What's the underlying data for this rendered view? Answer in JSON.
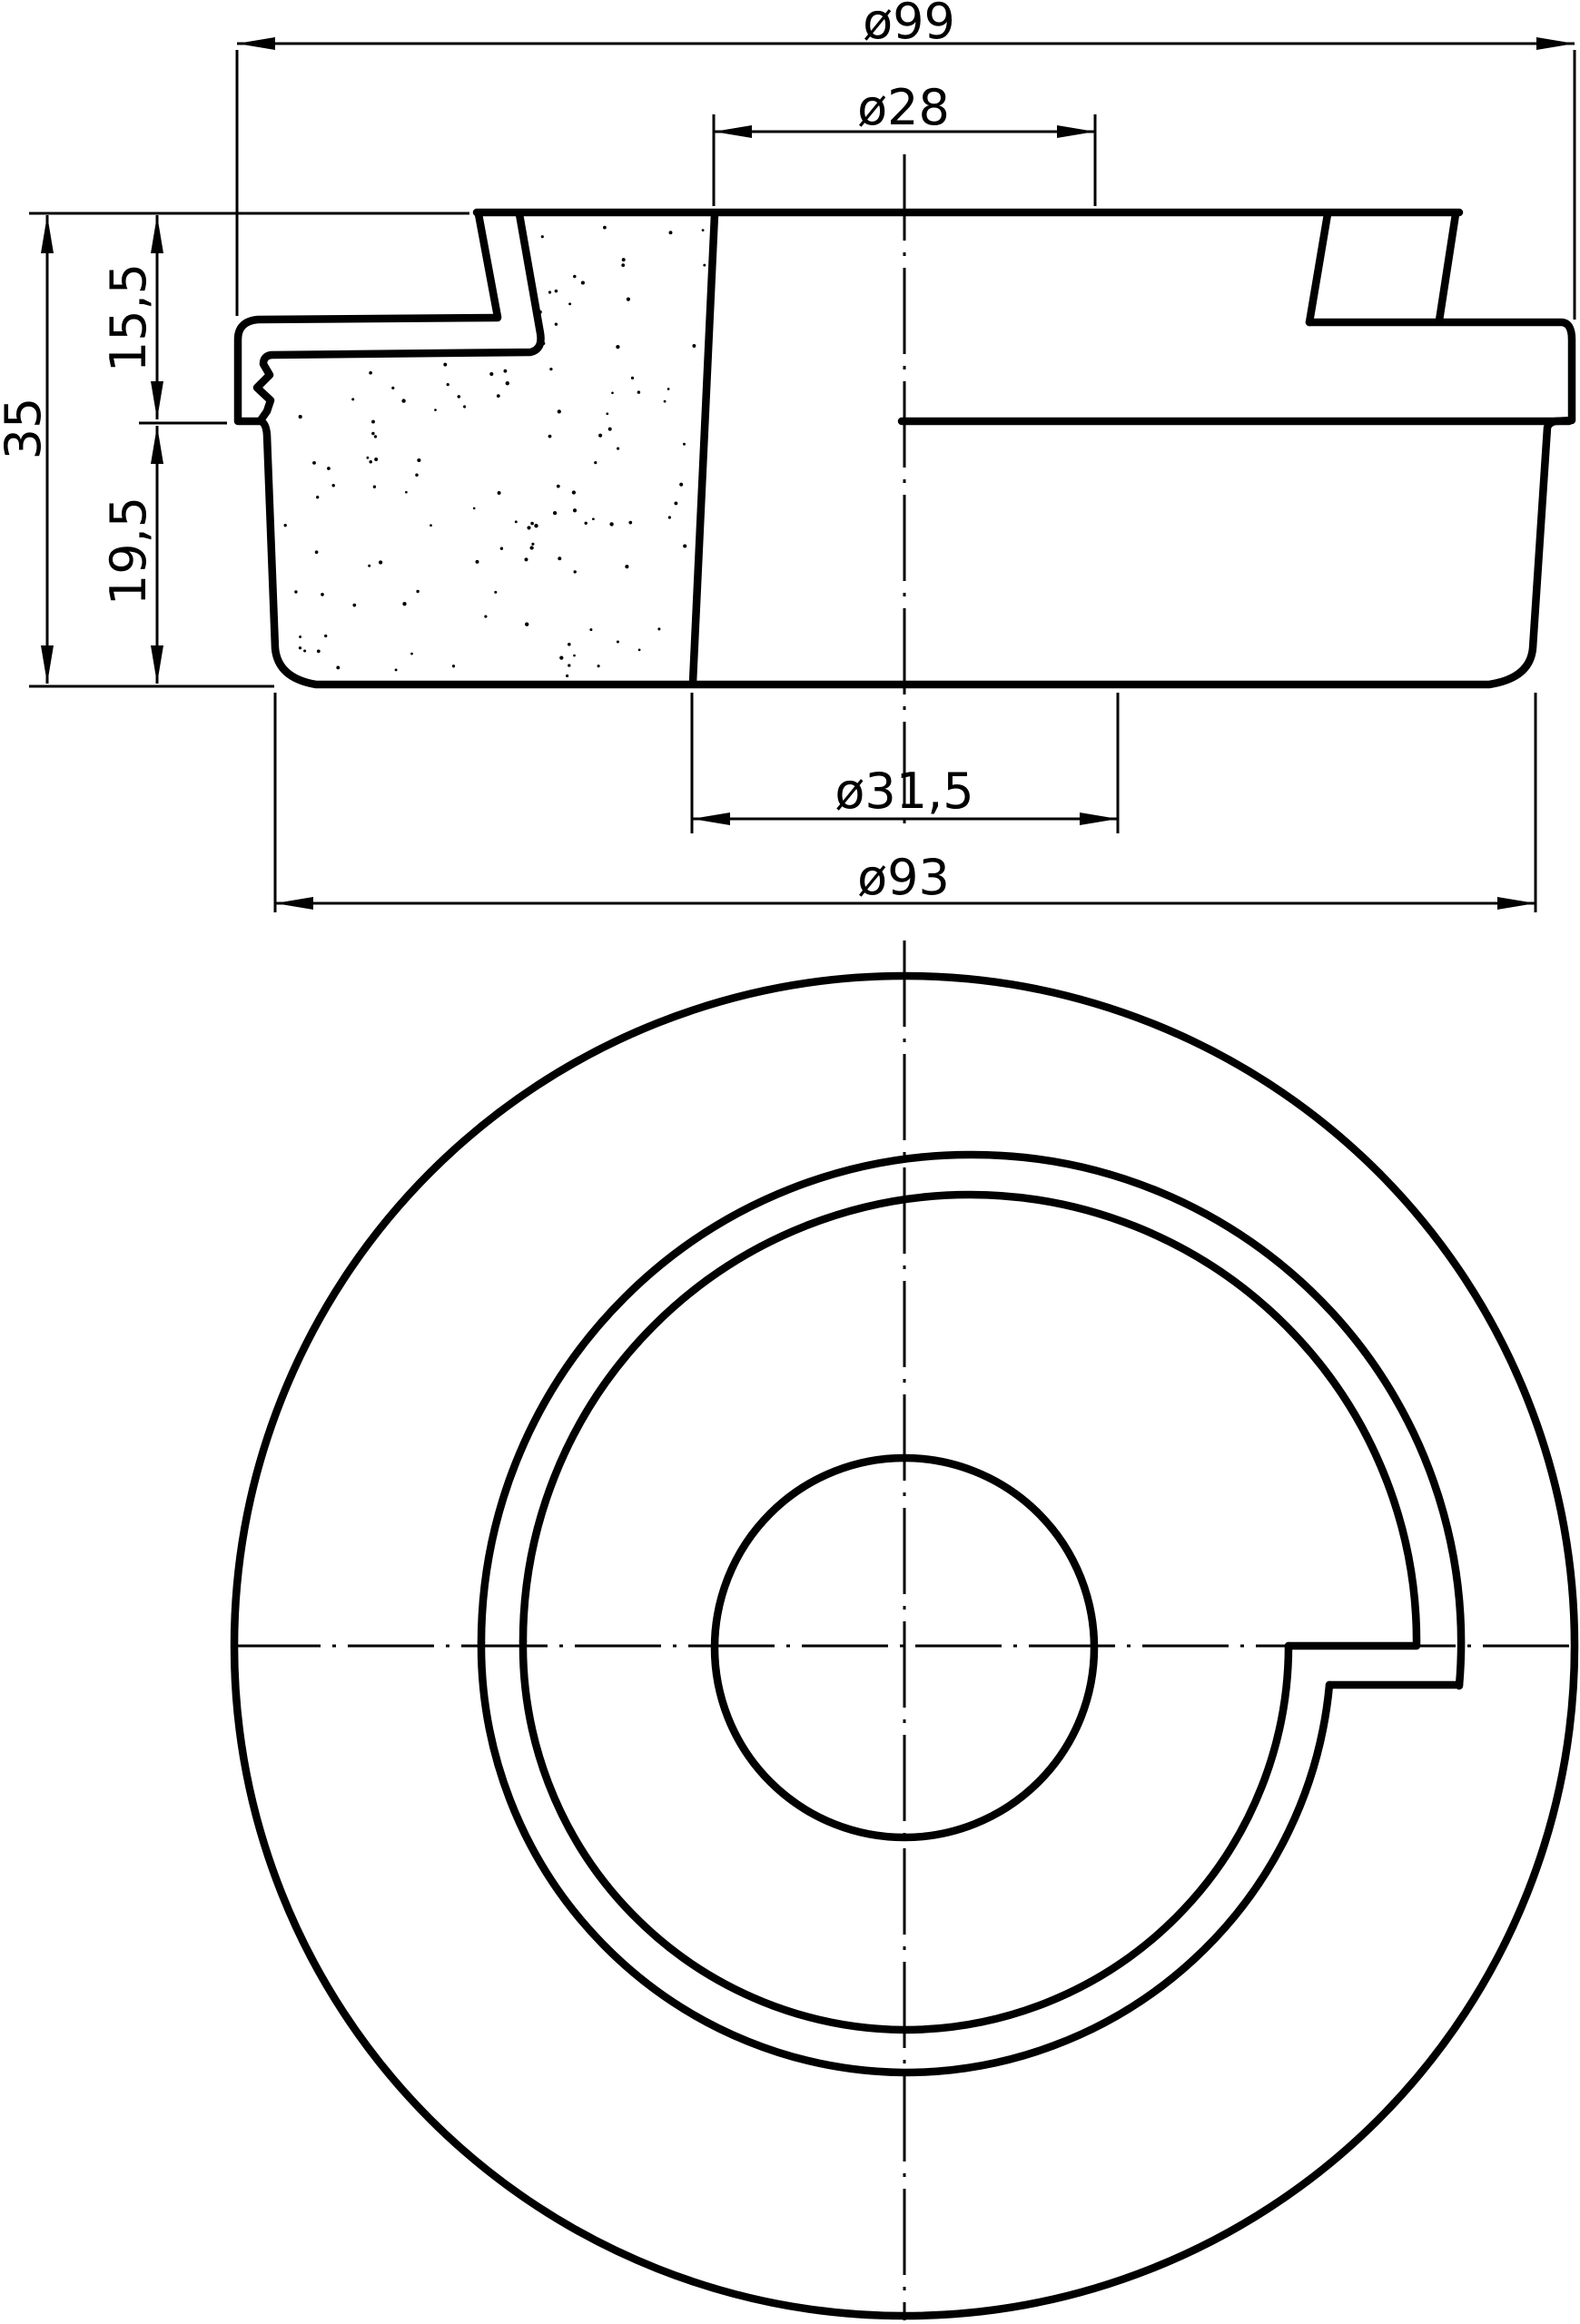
{
  "page": {
    "background": "#ffffff",
    "ink": "#000000",
    "type": "technical-drawing"
  },
  "views": {
    "section": {
      "name": "front half-section view",
      "dims": {
        "overall_diameter": "ø99",
        "top_hole_diameter": "ø28",
        "total_height": "35",
        "upper_height": "15,5",
        "lower_height": "19,5",
        "bottom_hole_diameter": "ø31,5",
        "base_diameter": "ø93"
      }
    },
    "plan": {
      "name": "plan view"
    }
  }
}
